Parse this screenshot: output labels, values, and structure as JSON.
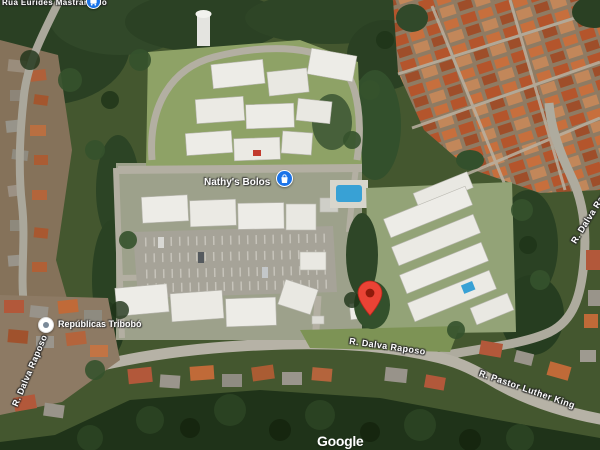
{
  "map": {
    "view_type": "satellite",
    "watermark": "Google",
    "marker": {
      "name": "destination-pin",
      "color": "#EA4335",
      "inner_color": "#8f1a0b"
    },
    "pois": [
      {
        "label": "Rua Eurides Mastrangelo",
        "icon": "bus-transit-icon",
        "icon_bg": "#1a73e8"
      },
      {
        "label": "Nathy's Bolos",
        "icon": "shopping-bag-icon",
        "icon_bg": "#1a73e8"
      },
      {
        "label": "Repúblicas Tribobó",
        "icon": "generic-poi-icon",
        "icon_bg": "#ffffff"
      }
    ],
    "streets": [
      {
        "text": "R. Dalva Raposo",
        "position": "center"
      },
      {
        "text": "R. Dalva Raposo",
        "position": "right-edge"
      },
      {
        "text": "R. Dalva Raposo",
        "position": "left-edge"
      },
      {
        "text": "R. Pastor Luther King",
        "position": "bottom-right"
      }
    ],
    "palette": {
      "vegetation": "#44572f",
      "forest_dark": "#24381d",
      "road": "#b2aea1",
      "building_white": "#edece7",
      "roof_red": "#b2582f",
      "pool_blue": "#38a1d5",
      "parking_gray": "#a6a398",
      "poi_blue": "#1a73e8"
    }
  }
}
